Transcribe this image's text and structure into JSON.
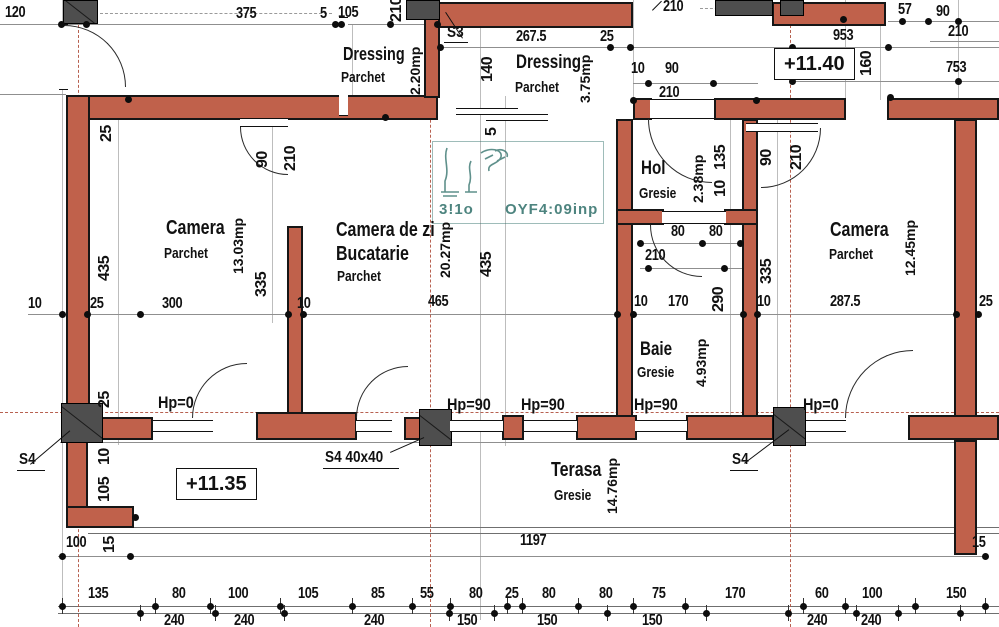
{
  "palette": {
    "wall": "#c0614b",
    "column": "#4e4e4e",
    "axis": "#b0503e",
    "watermark": "#2f6f69"
  },
  "rooms": [
    {
      "name": "Dressing",
      "finish": "Parchet",
      "area": "2.20mp",
      "nx": 343,
      "ny": 43,
      "fx": 341,
      "fy": 69,
      "ax": 407,
      "ay": 42,
      "ah": 58,
      "small": 1
    },
    {
      "name": "Dressing",
      "finish": "Parchet",
      "area": "3.75mp",
      "nx": 516,
      "ny": 52,
      "fx": 515,
      "fy": 79,
      "ax": 577,
      "ay": 50,
      "ah": 58,
      "small": 1
    },
    {
      "name": "Camera",
      "finish": "Parchet",
      "area": "13.03mp",
      "nx": 166,
      "ny": 217,
      "fx": 164,
      "fy": 245,
      "ax": 230,
      "ay": 212,
      "ah": 68
    },
    {
      "name": "Camera de zi",
      "line2": "Bucatarie",
      "finish": "Parchet",
      "area": "20.27mp",
      "nx": 336,
      "ny": 219,
      "l2x": 336,
      "l2y": 243,
      "fx": 337,
      "fy": 268,
      "ax": 437,
      "ay": 214,
      "ah": 72
    },
    {
      "name": "Hol",
      "finish": "Gresie",
      "area": "2.38mp",
      "nx": 641,
      "ny": 158,
      "fx": 639,
      "fy": 185,
      "ax": 690,
      "ay": 150,
      "ah": 58,
      "small": 1
    },
    {
      "name": "Baie",
      "finish": "Gresie",
      "area": "4.93mp",
      "nx": 640,
      "ny": 339,
      "fx": 637,
      "fy": 364,
      "ax": 693,
      "ay": 332,
      "ah": 62,
      "small": 1
    },
    {
      "name": "Camera",
      "finish": "Parchet",
      "area": "12.45mp",
      "nx": 830,
      "ny": 219,
      "fx": 829,
      "fy": 246,
      "ax": 902,
      "ay": 214,
      "ah": 68
    },
    {
      "name": "Terasa",
      "finish": "Gresie",
      "area": "14.76mp",
      "nx": 551,
      "ny": 459,
      "fx": 554,
      "fy": 487,
      "ax": 604,
      "ay": 457,
      "ah": 58
    }
  ],
  "levels": [
    {
      "label": "+11.40",
      "x": 774,
      "y": 48
    },
    {
      "label": "+11.35",
      "x": 176,
      "y": 468
    }
  ],
  "markers": [
    {
      "label": "S3",
      "x": 447,
      "y": 24
    },
    {
      "label": "S4",
      "x": 19,
      "y": 451
    },
    {
      "label": "S4  40x40",
      "x": 325,
      "y": 449
    },
    {
      "label": "S4",
      "x": 732,
      "y": 451
    }
  ],
  "hp": [
    {
      "label": "Hp=0",
      "x": 158,
      "y": 393
    },
    {
      "label": "Hp=90",
      "x": 447,
      "y": 395
    },
    {
      "label": "Hp=90",
      "x": 521,
      "y": 395
    },
    {
      "label": "Hp=90",
      "x": 634,
      "y": 395
    },
    {
      "label": "Hp=0",
      "x": 803,
      "y": 395
    }
  ],
  "watermark": {
    "left": "3!1o",
    "right": "OYF4:09inp"
  },
  "dims": [
    {
      "t": "120",
      "x": 5,
      "y": 5
    },
    {
      "t": "375",
      "x": 236,
      "y": 6
    },
    {
      "t": "5",
      "x": 320,
      "y": 6
    },
    {
      "t": "105",
      "x": 338,
      "y": 5
    },
    {
      "t": "210",
      "x": 389,
      "y": -4,
      "r": 1,
      "h": 26
    },
    {
      "t": "210",
      "x": 663,
      "y": -1
    },
    {
      "t": "267.5",
      "x": 516,
      "y": 29
    },
    {
      "t": "25",
      "x": 600,
      "y": 29
    },
    {
      "t": "140",
      "x": 480,
      "y": 50,
      "r": 1,
      "h": 38
    },
    {
      "t": "10",
      "x": 631,
      "y": 61
    },
    {
      "t": "90",
      "x": 665,
      "y": 61
    },
    {
      "t": "210",
      "x": 659,
      "y": 85
    },
    {
      "t": "953",
      "x": 833,
      "y": 28
    },
    {
      "t": "57",
      "x": 898,
      "y": 2
    },
    {
      "t": "90",
      "x": 936,
      "y": 4
    },
    {
      "t": "210",
      "x": 948,
      "y": 24
    },
    {
      "t": "753",
      "x": 946,
      "y": 60
    },
    {
      "t": "160",
      "x": 859,
      "y": 42,
      "r": 1,
      "h": 42
    },
    {
      "t": "25",
      "x": 99,
      "y": 121,
      "r": 1,
      "h": 26
    },
    {
      "t": "435",
      "x": 97,
      "y": 247,
      "r": 1,
      "h": 42
    },
    {
      "t": "90",
      "x": 255,
      "y": 147,
      "r": 1,
      "h": 26
    },
    {
      "t": "210",
      "x": 283,
      "y": 139,
      "r": 1,
      "h": 38
    },
    {
      "t": "335",
      "x": 254,
      "y": 267,
      "r": 1,
      "h": 34
    },
    {
      "t": "5",
      "x": 484,
      "y": 124,
      "r": 1,
      "h": 16
    },
    {
      "t": "435",
      "x": 479,
      "y": 243,
      "r": 1,
      "h": 42
    },
    {
      "t": "135",
      "x": 713,
      "y": 141,
      "r": 1,
      "h": 32
    },
    {
      "t": "10",
      "x": 713,
      "y": 179,
      "r": 1,
      "h": 20
    },
    {
      "t": "90",
      "x": 759,
      "y": 145,
      "r": 1,
      "h": 26
    },
    {
      "t": "210",
      "x": 789,
      "y": 138,
      "r": 1,
      "h": 38
    },
    {
      "t": "80",
      "x": 671,
      "y": 224
    },
    {
      "t": "80",
      "x": 709,
      "y": 224
    },
    {
      "t": "210",
      "x": 645,
      "y": 248
    },
    {
      "t": "335",
      "x": 759,
      "y": 254,
      "r": 1,
      "h": 34
    },
    {
      "t": "290",
      "x": 711,
      "y": 281,
      "r": 1,
      "h": 36
    },
    {
      "t": "10",
      "x": 28,
      "y": 296
    },
    {
      "t": "25",
      "x": 90,
      "y": 296
    },
    {
      "t": "300",
      "x": 162,
      "y": 296
    },
    {
      "t": "10",
      "x": 297,
      "y": 296
    },
    {
      "t": "465",
      "x": 428,
      "y": 294
    },
    {
      "t": "10",
      "x": 634,
      "y": 294
    },
    {
      "t": "170",
      "x": 668,
      "y": 294
    },
    {
      "t": "10",
      "x": 757,
      "y": 294
    },
    {
      "t": "287.5",
      "x": 830,
      "y": 294
    },
    {
      "t": "25",
      "x": 979,
      "y": 294
    },
    {
      "t": "25",
      "x": 97,
      "y": 387,
      "r": 1,
      "h": 26
    },
    {
      "t": "10",
      "x": 97,
      "y": 447,
      "r": 1,
      "h": 20
    },
    {
      "t": "105",
      "x": 97,
      "y": 469,
      "r": 1,
      "h": 40
    },
    {
      "t": "100",
      "x": 66,
      "y": 535
    },
    {
      "t": "15",
      "x": 102,
      "y": 534,
      "r": 1,
      "h": 22
    },
    {
      "t": "1197",
      "x": 520,
      "y": 533
    },
    {
      "t": "15",
      "x": 972,
      "y": 535
    },
    {
      "t": "135",
      "x": 88,
      "y": 586
    },
    {
      "t": "80",
      "x": 172,
      "y": 586
    },
    {
      "t": "100",
      "x": 228,
      "y": 586
    },
    {
      "t": "105",
      "x": 298,
      "y": 586
    },
    {
      "t": "85",
      "x": 371,
      "y": 586
    },
    {
      "t": "55",
      "x": 420,
      "y": 586
    },
    {
      "t": "80",
      "x": 469,
      "y": 586
    },
    {
      "t": "25",
      "x": 505,
      "y": 586
    },
    {
      "t": "80",
      "x": 542,
      "y": 586
    },
    {
      "t": "80",
      "x": 599,
      "y": 586
    },
    {
      "t": "75",
      "x": 652,
      "y": 586
    },
    {
      "t": "170",
      "x": 725,
      "y": 586
    },
    {
      "t": "60",
      "x": 815,
      "y": 586
    },
    {
      "t": "100",
      "x": 862,
      "y": 586
    },
    {
      "t": "150",
      "x": 946,
      "y": 586
    },
    {
      "t": "240",
      "x": 164,
      "y": 613
    },
    {
      "t": "240",
      "x": 234,
      "y": 613
    },
    {
      "t": "240",
      "x": 364,
      "y": 613
    },
    {
      "t": "150",
      "x": 457,
      "y": 613
    },
    {
      "t": "150",
      "x": 537,
      "y": 613
    },
    {
      "t": "150",
      "x": 642,
      "y": 613
    },
    {
      "t": "240",
      "x": 807,
      "y": 613
    },
    {
      "t": "240",
      "x": 861,
      "y": 613
    }
  ]
}
